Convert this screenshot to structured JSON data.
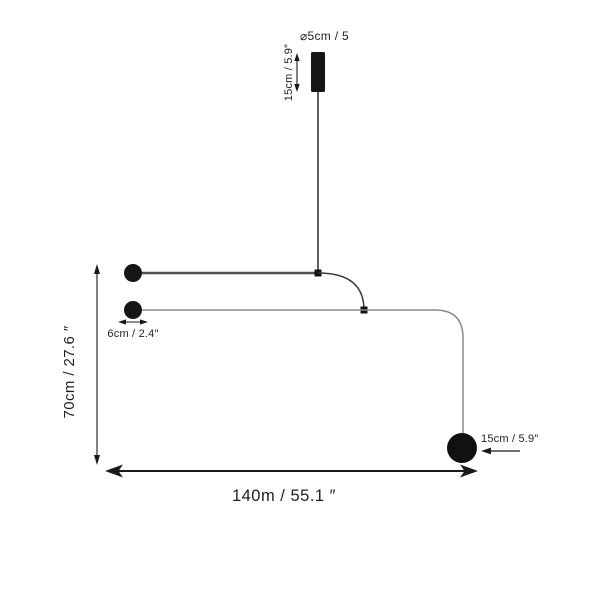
{
  "diagram": {
    "kind": "pendant-lamp-dimension-diagram",
    "colors": {
      "background": "#ffffff",
      "ink": "#1a1a1a",
      "fixture_black": "#161616",
      "line_dark": "#3a3a3a",
      "arm_primary": "#4f4f4f",
      "arm_secondary": "#8a8a8a"
    },
    "labels": {
      "canopy_diameter": "⌀5cm / 5",
      "canopy_height": "15cm / 5.9″",
      "arm_offset": "6cm / 2.4″",
      "overall_height": "70cm / 27.6 ″",
      "overall_width": "140m / 55.1 ″",
      "sphere_diameter": "15cm / 5.9″"
    }
  }
}
